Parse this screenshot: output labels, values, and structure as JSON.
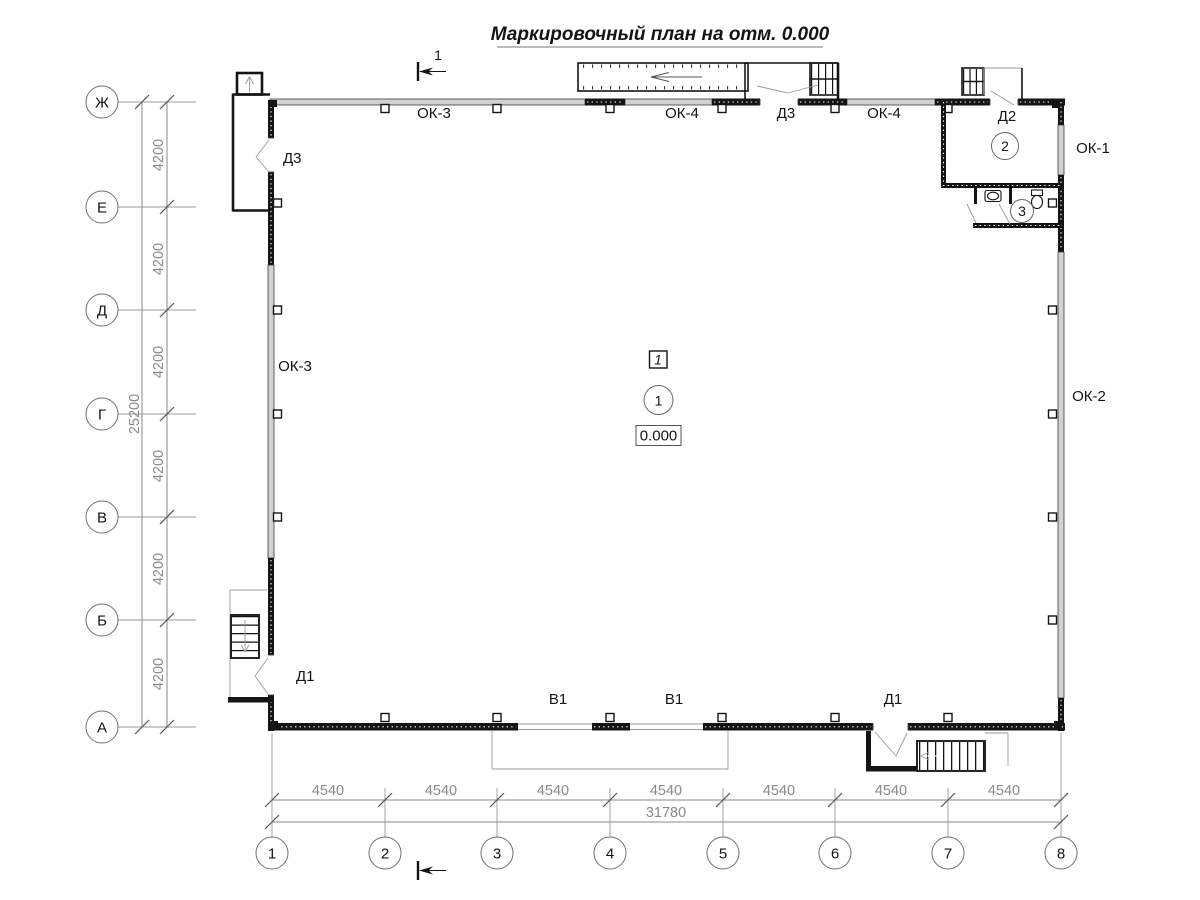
{
  "title": "Маркировочный план на отм. 0.000",
  "section": {
    "number": "1"
  },
  "row_axes": [
    "Ж",
    "Е",
    "Д",
    "Г",
    "В",
    "Б",
    "А"
  ],
  "col_axes": [
    "1",
    "2",
    "3",
    "4",
    "5",
    "6",
    "7",
    "8"
  ],
  "dimensions": {
    "row_spacing": "4200",
    "row_total": "25200",
    "col_spacing": "4540",
    "col_total": "31780"
  },
  "marks": {
    "window_ok3": "ОК-3",
    "window_ok4": "ОК-4",
    "window_ok1": "ОК-1",
    "window_ok2": "ОК-2",
    "door_d1": "Д1",
    "door_d2": "Д2",
    "door_d3": "Д3",
    "gate_v1": "В1"
  },
  "rooms": {
    "main_zone": "1",
    "main_number": "1",
    "main_elevation": "0.000",
    "vestibule_number": "2",
    "wc_number": "3"
  }
}
